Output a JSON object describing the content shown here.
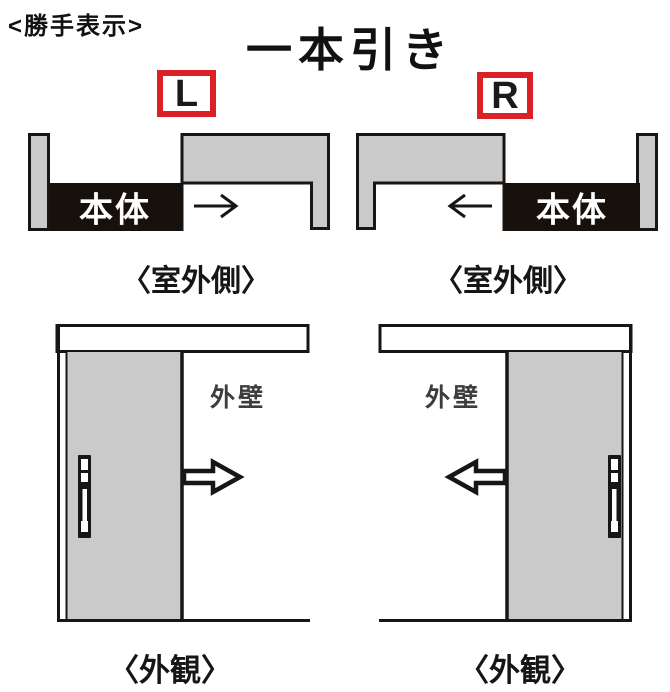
{
  "header": {
    "note": "<勝手表示>",
    "title": "一本引き"
  },
  "colors": {
    "badge_red": "#da2128",
    "panel_gray": "#cacaca",
    "line_black": "#161616",
    "body_box_black": "#17100b",
    "wall_label_gray": "#3d3d3d"
  },
  "plans": {
    "caption_left": "〈室外側〉",
    "caption_right": "〈室外側〉",
    "left": {
      "handedness": "L",
      "body_label": "本体",
      "slide_direction": "right"
    },
    "right": {
      "handedness": "R",
      "body_label": "本体",
      "slide_direction": "left"
    }
  },
  "elevations": {
    "caption_left": "〈外観〉",
    "caption_right": "〈外観〉",
    "left": {
      "wall_label": "外壁",
      "slide_direction": "right"
    },
    "right": {
      "wall_label": "外壁",
      "slide_direction": "left"
    }
  }
}
